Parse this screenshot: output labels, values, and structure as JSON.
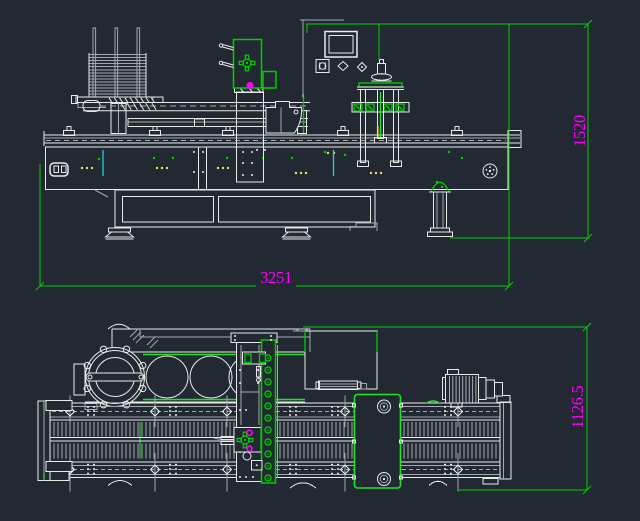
{
  "canvas": {
    "width": 640,
    "height": 521
  },
  "palette": {
    "background": "#232933",
    "line_white": "#e9e9e9",
    "line_gray": "#a5a9af",
    "accent_green": "#00cd00",
    "accent_green_bright": "#21e421",
    "dim_text_magenta": "#ff00ff",
    "mark_yellow": "#e9e455",
    "mark_cyan": "#2ad0d0"
  },
  "dimensions": {
    "front_width": "3251",
    "front_height": "1520",
    "plan_depth": "1126.5"
  }
}
